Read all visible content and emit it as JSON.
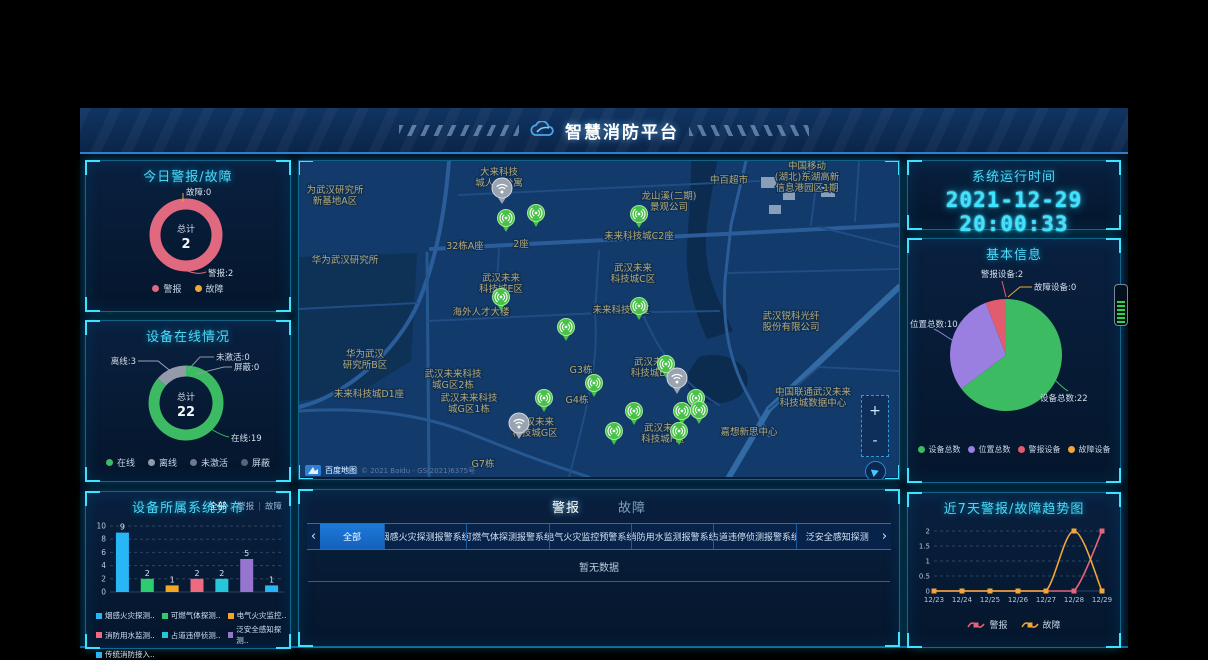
{
  "header": {
    "title": "智慧消防平台"
  },
  "icons": {
    "header_logo": "cloud-logo-icon",
    "device_marker": "wifi-signal-pin-icon",
    "cluster_marker": "wifi-cluster-pin-icon",
    "locate": "navigate-arrow-icon",
    "baidu_logo": "baidu-maps-logo-icon"
  },
  "colors": {
    "accent": "#3fe3ff",
    "panel_border": "#1b96c3",
    "map_background": "#123a6b",
    "clock": "#3fe3ff",
    "active_tab": "#1d7ad8"
  },
  "left": {
    "today": {
      "title": "今日警报/故障"
    },
    "online": {
      "title": "设备在线情况"
    },
    "systems": {
      "title": "设备所属系统分布",
      "filters": [
        "全部",
        "警报",
        "故障"
      ],
      "active_filter": "全部"
    }
  },
  "map": {
    "attribution": "百度地图",
    "copyright": "© 2021 Baidu - GS(2021)6375号",
    "zoom_in": "+",
    "zoom_out": "-",
    "labels": [
      {
        "x": 200,
        "y": 14,
        "lines": [
          "大来科技",
          "城人才公寓"
        ]
      },
      {
        "x": 430,
        "y": 22,
        "lines": [
          "中百超市"
        ]
      },
      {
        "x": 36,
        "y": 32,
        "lines": [
          "为武汉研究所",
          "新基地A区"
        ]
      },
      {
        "x": 370,
        "y": 38,
        "lines": [
          "龙山溪(二期)",
          "景观公司"
        ]
      },
      {
        "x": 508,
        "y": 8,
        "lines": [
          "中国移动",
          "(湖北)东湖高新",
          "信息港园区1期"
        ]
      },
      {
        "x": 166,
        "y": 88,
        "lines": [
          "32栋A座"
        ]
      },
      {
        "x": 222,
        "y": 86,
        "lines": [
          "2座"
        ]
      },
      {
        "x": 340,
        "y": 78,
        "lines": [
          "未来科技城C2座"
        ]
      },
      {
        "x": 46,
        "y": 102,
        "lines": [
          "华为武汉研究所"
        ]
      },
      {
        "x": 202,
        "y": 120,
        "lines": [
          "武汉未来",
          "科技城E区"
        ]
      },
      {
        "x": 334,
        "y": 110,
        "lines": [
          "武汉未来",
          "科技城C区"
        ]
      },
      {
        "x": 182,
        "y": 154,
        "lines": [
          "海外人才大楼"
        ]
      },
      {
        "x": 322,
        "y": 152,
        "lines": [
          "未来科技大厦"
        ]
      },
      {
        "x": 492,
        "y": 158,
        "lines": [
          "武汉锐科光纤",
          "股份有限公司"
        ]
      },
      {
        "x": 66,
        "y": 196,
        "lines": [
          "华为武汉",
          "研究所B区"
        ]
      },
      {
        "x": 70,
        "y": 236,
        "lines": [
          "未来科技城D1座"
        ]
      },
      {
        "x": 154,
        "y": 216,
        "lines": [
          "武汉未来科技",
          "城G区2栋"
        ]
      },
      {
        "x": 170,
        "y": 240,
        "lines": [
          "武汉未来科技",
          "城G区1栋"
        ]
      },
      {
        "x": 236,
        "y": 264,
        "lines": [
          "武汉未来",
          "科技城G区"
        ]
      },
      {
        "x": 282,
        "y": 212,
        "lines": [
          "G3栋"
        ]
      },
      {
        "x": 278,
        "y": 242,
        "lines": [
          "G4栋"
        ]
      },
      {
        "x": 184,
        "y": 306,
        "lines": [
          "G7栋"
        ]
      },
      {
        "x": 514,
        "y": 234,
        "lines": [
          "中国联通武汉未来",
          "科技城数据中心"
        ]
      },
      {
        "x": 450,
        "y": 274,
        "lines": [
          "嘉想新思中心"
        ]
      },
      {
        "x": 364,
        "y": 270,
        "lines": [
          "武汉未来",
          "科技城F区"
        ]
      },
      {
        "x": 354,
        "y": 204,
        "lines": [
          "武汉未来",
          "科技城B区"
        ]
      }
    ],
    "markers": [
      {
        "x": 207,
        "y": 57,
        "type": "device"
      },
      {
        "x": 237,
        "y": 52,
        "type": "device"
      },
      {
        "x": 202,
        "y": 136,
        "type": "device"
      },
      {
        "x": 340,
        "y": 53,
        "type": "device"
      },
      {
        "x": 340,
        "y": 145,
        "type": "device"
      },
      {
        "x": 267,
        "y": 166,
        "type": "device"
      },
      {
        "x": 295,
        "y": 222,
        "type": "device"
      },
      {
        "x": 245,
        "y": 237,
        "type": "device"
      },
      {
        "x": 367,
        "y": 203,
        "type": "device"
      },
      {
        "x": 397,
        "y": 237,
        "type": "device"
      },
      {
        "x": 383,
        "y": 250,
        "type": "device"
      },
      {
        "x": 400,
        "y": 249,
        "type": "device"
      },
      {
        "x": 335,
        "y": 250,
        "type": "device"
      },
      {
        "x": 315,
        "y": 270,
        "type": "device"
      },
      {
        "x": 380,
        "y": 270,
        "type": "device"
      },
      {
        "x": 203,
        "y": 27,
        "type": "cluster"
      },
      {
        "x": 220,
        "y": 262,
        "type": "cluster"
      },
      {
        "x": 378,
        "y": 217,
        "type": "cluster"
      }
    ]
  },
  "alarm": {
    "tabs": [
      {
        "label": "警报",
        "active": true
      },
      {
        "label": "故障",
        "active": false
      }
    ],
    "subtabs": [
      "全部",
      "烟感火灾探测报警系统",
      "可燃气体探测报警系统",
      "电气火灾监控预警系统",
      "消防用水监测报警系统",
      "占道违停侦测报警系统",
      "泛安全感知探测"
    ],
    "active_subtab": "全部",
    "prev_arrow": "‹",
    "next_arrow": "›",
    "empty_text": "暂无数据"
  },
  "right": {
    "runtime": {
      "title": "系统运行时间",
      "datetime": "2021-12-29 20:00:33"
    },
    "info": {
      "title": "基本信息"
    },
    "trend": {
      "title": "近7天警报/故障趋势图"
    }
  },
  "chart_data": [
    {
      "id": "today_donut",
      "type": "pie",
      "title": "今日警报/故障",
      "total_label": "总计",
      "total": 2,
      "series": [
        {
          "name": "警报",
          "value": 2,
          "color": "#e0687f"
        },
        {
          "name": "故障",
          "value": 0,
          "color": "#f0a63a"
        }
      ]
    },
    {
      "id": "online_donut",
      "type": "pie",
      "title": "设备在线情况",
      "total_label": "总计",
      "total": 22,
      "series": [
        {
          "name": "在线",
          "value": 19,
          "color": "#3dbb63"
        },
        {
          "name": "离线",
          "value": 3,
          "color": "#939bab"
        },
        {
          "name": "未激活",
          "value": 0,
          "color": "#6e7891"
        },
        {
          "name": "屏蔽",
          "value": 0,
          "color": "#59637e"
        }
      ]
    },
    {
      "id": "systems_bar",
      "type": "bar",
      "title": "设备所属系统分布",
      "ylim": [
        0,
        10
      ],
      "yticks": [
        0,
        2,
        4,
        6,
        8,
        10
      ],
      "categories": [
        "烟感火灾探测..",
        "可燃气体探测..",
        "电气火灾监控..",
        "消防用水监测..",
        "占道违停侦测..",
        "泛安全感知探测..",
        "传统消防接入.."
      ],
      "values": [
        9,
        2,
        1,
        2,
        2,
        5,
        1
      ],
      "colors": [
        "#29b6f6",
        "#2ecc71",
        "#f5a623",
        "#ef6a7f",
        "#26c6da",
        "#9575cd",
        "#29b6f6"
      ]
    },
    {
      "id": "info_pie",
      "type": "pie",
      "title": "基本信息",
      "series": [
        {
          "name": "设备总数",
          "value": 22,
          "color": "#3dbb63"
        },
        {
          "name": "位置总数",
          "value": 10,
          "color": "#9b7fe0"
        },
        {
          "name": "警报设备",
          "value": 2,
          "color": "#e05c6e"
        },
        {
          "name": "故障设备",
          "value": 0,
          "color": "#f0a63a"
        }
      ]
    },
    {
      "id": "trend_line",
      "type": "line",
      "title": "近7天警报/故障趋势图",
      "ylim": [
        0,
        2
      ],
      "yticks": [
        0,
        0.5,
        1,
        1.5,
        2
      ],
      "x": [
        "12/23",
        "12/24",
        "12/25",
        "12/26",
        "12/27",
        "12/28",
        "12/29"
      ],
      "series": [
        {
          "name": "警报",
          "color": "#e4647c",
          "values": [
            0,
            0,
            0,
            0,
            0,
            0,
            2
          ]
        },
        {
          "name": "故障",
          "color": "#f0a63a",
          "values": [
            0,
            0,
            0,
            0,
            0,
            2,
            0
          ]
        }
      ]
    }
  ]
}
